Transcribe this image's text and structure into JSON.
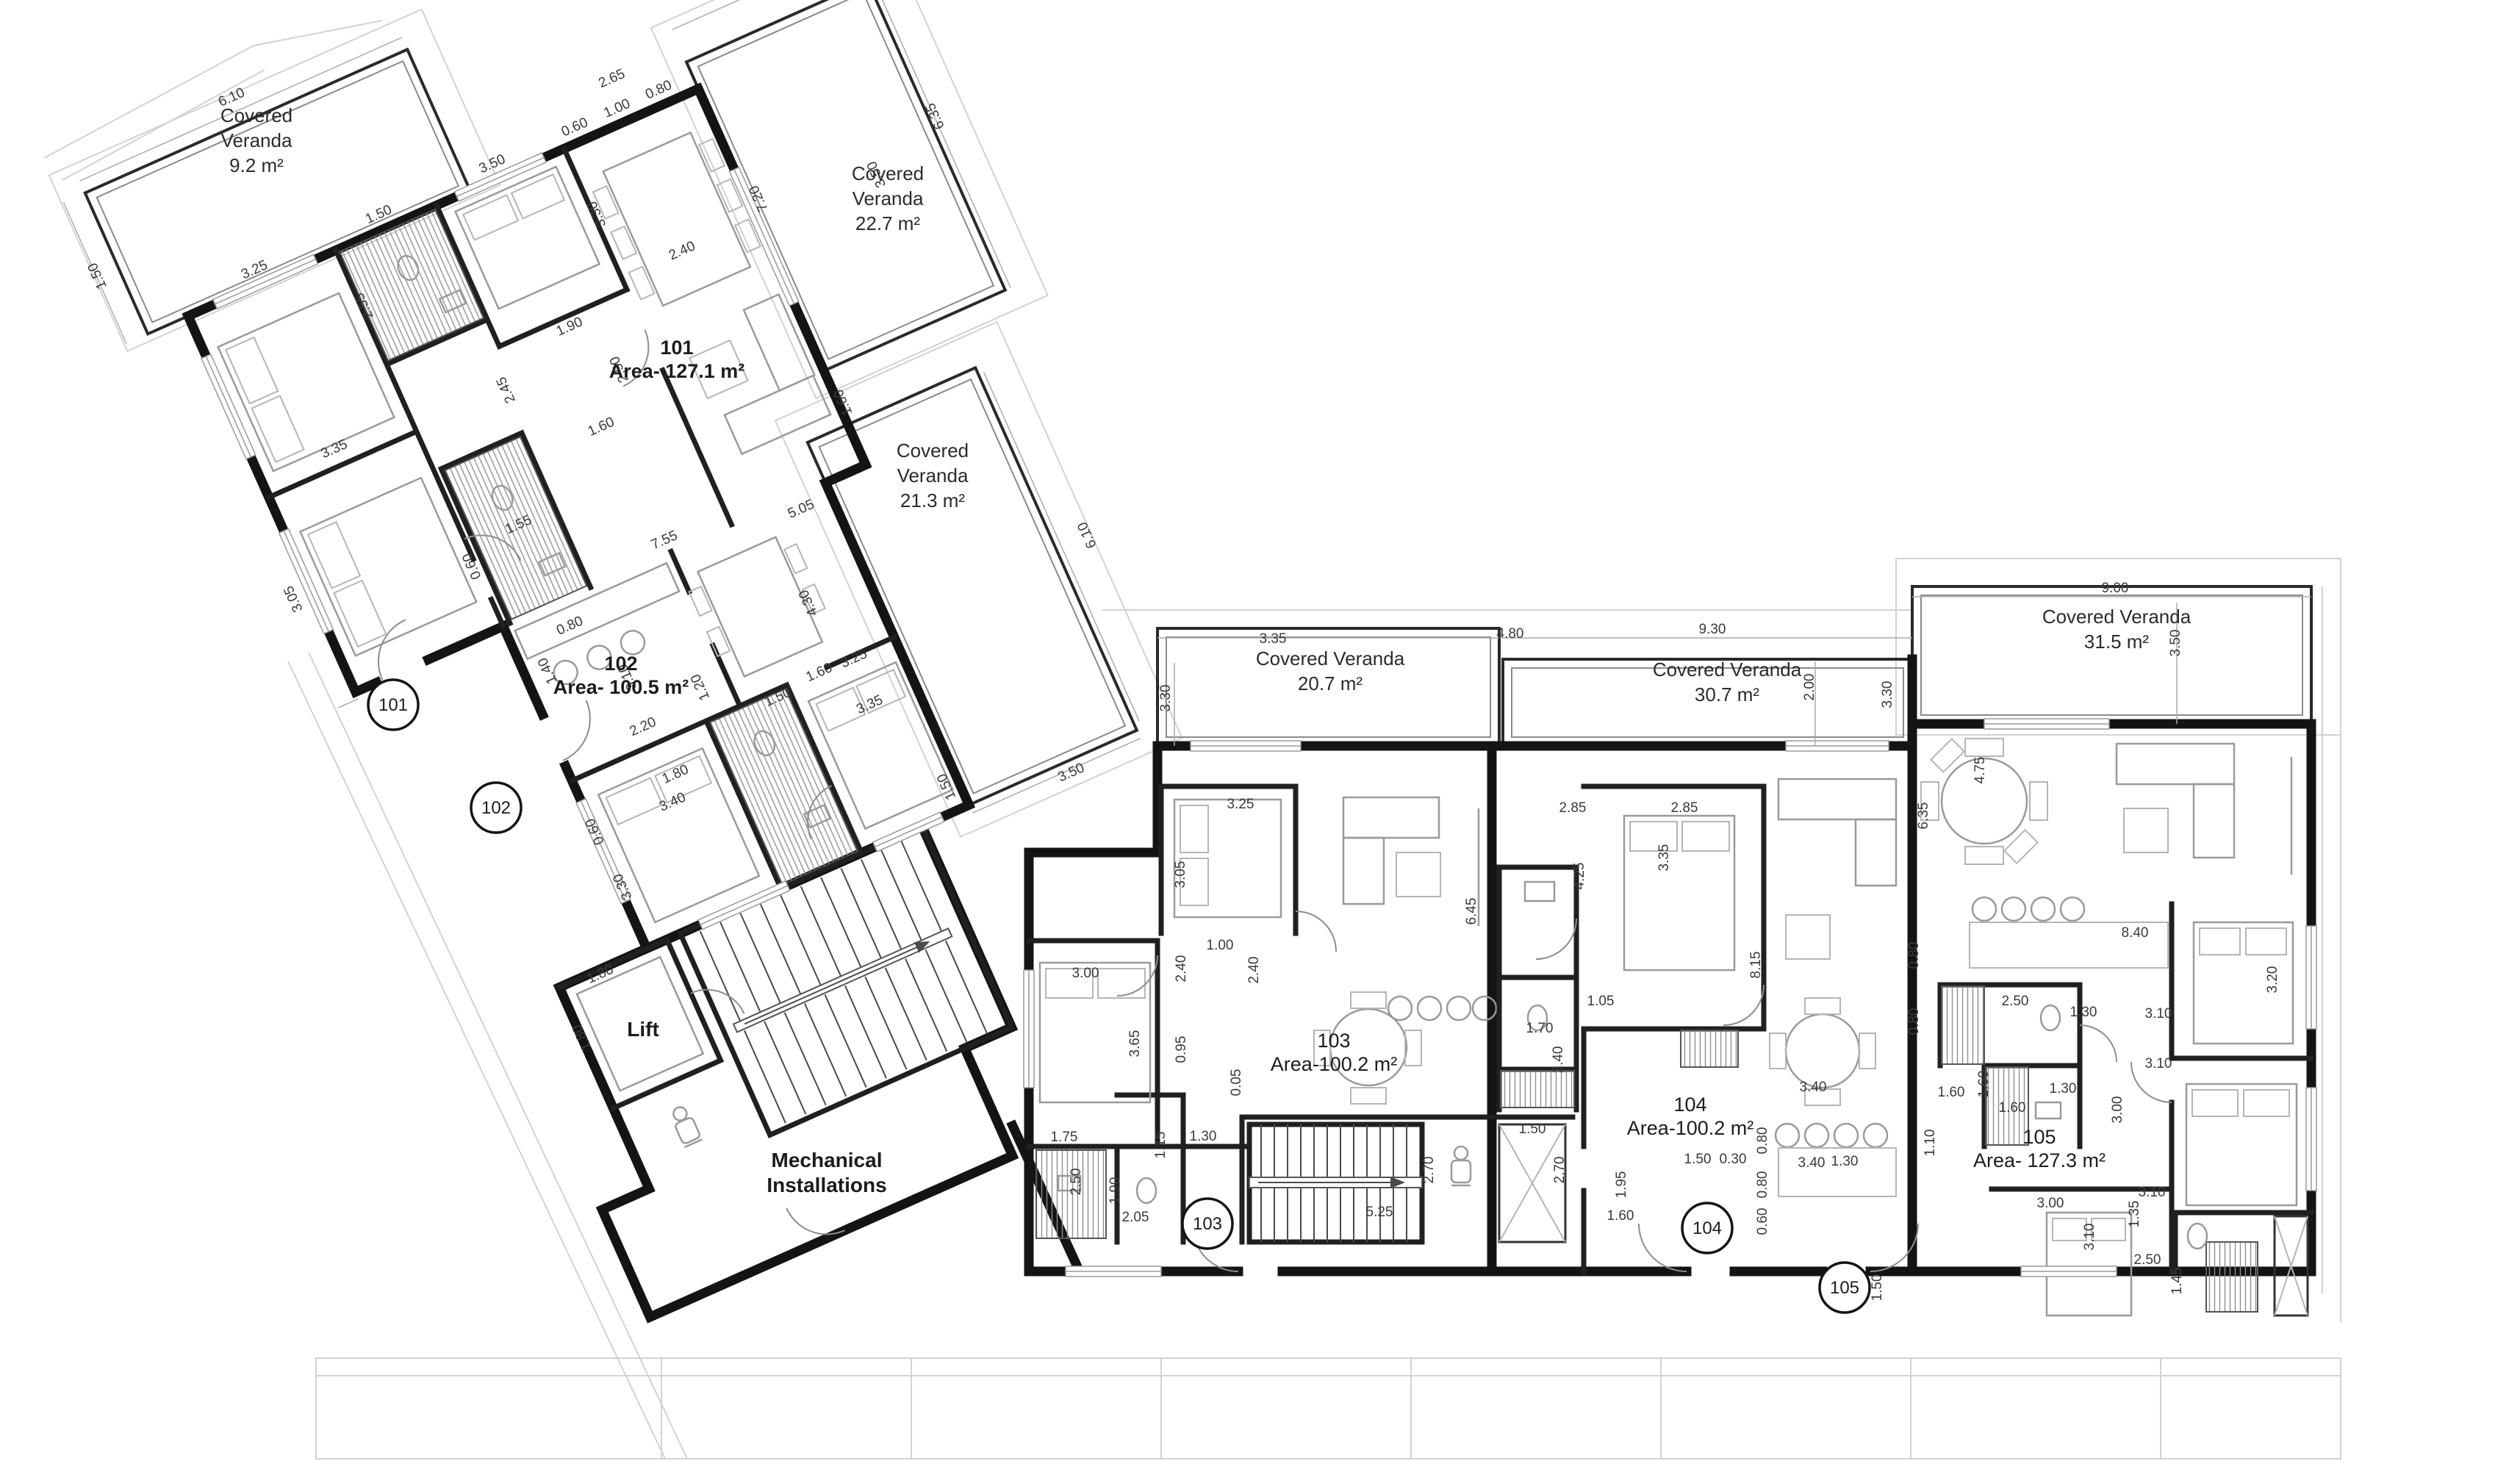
{
  "drawing": {
    "type": "architectural-floor-plan",
    "floor": "apartment level",
    "wall_color": "#141414",
    "paper_color": "#ffffff"
  },
  "apartments": [
    {
      "number": "101",
      "area": "Area- 127.1 m²"
    },
    {
      "number": "102",
      "area": "Area- 100.5 m²"
    },
    {
      "number": "103",
      "area": "Area-100.2 m²"
    },
    {
      "number": "104",
      "area": "Area-100.2 m²"
    },
    {
      "number": "105",
      "area": "Area- 127.3 m²"
    }
  ],
  "verandas": [
    {
      "l1": "Covered",
      "l2": "Veranda",
      "l3": "9.2 m²"
    },
    {
      "l1": "Covered",
      "l2": "Veranda",
      "l3": "22.7 m²"
    },
    {
      "l1": "Covered",
      "l2": "Veranda",
      "l3": "21.3 m²"
    },
    {
      "l1": "Covered Veranda",
      "l2": "20.7 m²"
    },
    {
      "l1": "Covered Veranda",
      "l2": "30.7 m²"
    },
    {
      "l1": "Covered Veranda",
      "l2": "31.5 m²"
    }
  ],
  "rooms": {
    "lift": "Lift",
    "mech1": "Mechanical",
    "mech2": "Installations"
  },
  "bubbles": [
    [
      "101",
      535,
      959
    ],
    [
      "102",
      675,
      1099
    ],
    [
      "103",
      1643,
      1665
    ],
    [
      "104",
      2323,
      1671
    ],
    [
      "105",
      2510,
      1752
    ]
  ],
  "dims": [
    [
      "6.10",
      175,
      -242,
      0,
      "L"
    ],
    [
      "1.50",
      -85,
      -100,
      -90,
      "L"
    ],
    [
      "3.25",
      108,
      -15,
      0,
      "L"
    ],
    [
      "1.50",
      293,
      -15,
      0,
      "L"
    ],
    [
      "2.55",
      230,
      85,
      -90,
      "L"
    ],
    [
      "3.50",
      462,
      -15,
      0,
      "L"
    ],
    [
      "0.60",
      585,
      -15,
      0,
      "L"
    ],
    [
      "1.00",
      648,
      -15,
      0,
      "L"
    ],
    [
      "0.80",
      710,
      -15,
      0,
      "L"
    ],
    [
      "3.30",
      570,
      100,
      -90,
      "L"
    ],
    [
      "2.65",
      658,
      -55,
      0,
      "L"
    ],
    [
      "3.35",
      108,
      252,
      0,
      "L"
    ],
    [
      "3.05",
      -20,
      410,
      -90,
      "L"
    ],
    [
      "2.45",
      360,
      268,
      -90,
      "L"
    ],
    [
      "1.90",
      468,
      230,
      0,
      "L"
    ],
    [
      "1.55",
      295,
      448,
      0,
      "L"
    ],
    [
      "0.60",
      220,
      468,
      -90,
      "L"
    ],
    [
      "1.60",
      452,
      372,
      0,
      "L"
    ],
    [
      "2.50",
      512,
      305,
      -90,
      "L"
    ],
    [
      "2.40",
      650,
      198,
      0,
      "L"
    ],
    [
      "5.05",
      655,
      585,
      0,
      "L"
    ],
    [
      "1.60",
      772,
      470,
      -90,
      "L"
    ],
    [
      "7.20",
      780,
      170,
      -90,
      "L"
    ],
    [
      "3.50",
      940,
      205,
      -90,
      "L"
    ],
    [
      "6.35",
      1045,
      165,
      -90,
      "L"
    ],
    [
      "7.55",
      468,
      548,
      0,
      "L"
    ],
    [
      "4.30",
      618,
      700,
      -90,
      "L"
    ],
    [
      "0.80",
      303,
      602,
      0,
      "L"
    ],
    [
      "1.40",
      256,
      640,
      -90,
      "L"
    ],
    [
      "3.10",
      352,
      692,
      -90,
      "L"
    ],
    [
      "2.20",
      338,
      768,
      0,
      "L"
    ],
    [
      "1.20",
      437,
      745,
      -90,
      "L"
    ],
    [
      "1.50",
      522,
      806,
      0,
      "L"
    ],
    [
      "1.60",
      587,
      798,
      0,
      "L"
    ],
    [
      "1.80",
      352,
      845,
      0,
      "L"
    ],
    [
      "3.40",
      333,
      878,
      0,
      "L"
    ],
    [
      "0.60",
      226,
      866,
      -90,
      "L"
    ],
    [
      "3.30",
      230,
      950,
      -90,
      "L"
    ],
    [
      "3.35",
      632,
      866,
      0,
      "L"
    ],
    [
      "3.25",
      638,
      800,
      0,
      "L"
    ],
    [
      "1.80",
      148,
      1052,
      0,
      "L"
    ],
    [
      "1.80",
      96,
      1115,
      -90,
      "L"
    ],
    [
      "6.10",
      1002,
      770,
      -90,
      "L"
    ],
    [
      "3.50",
      845,
      1062,
      0,
      "L"
    ],
    [
      "1.50",
      688,
      1005,
      -90,
      "L"
    ],
    [
      "3.35",
      1732,
      875,
      0,
      "R"
    ],
    [
      "4.80",
      2055,
      868,
      0,
      "R"
    ],
    [
      "9.30",
      2330,
      862,
      0,
      "R"
    ],
    [
      "3.30",
      1592,
      950,
      -90,
      "R"
    ],
    [
      "2.00",
      2468,
      935,
      -90,
      "R"
    ],
    [
      "3.30",
      2574,
      945,
      -90,
      "R"
    ],
    [
      "9.00",
      2878,
      806,
      0,
      "R"
    ],
    [
      "3.50",
      2966,
      875,
      -90,
      "R"
    ],
    [
      "3.25",
      1688,
      1100,
      0,
      "R"
    ],
    [
      "3.05",
      1612,
      1190,
      -90,
      "R"
    ],
    [
      "6.45",
      2008,
      1240,
      -90,
      "R"
    ],
    [
      "3.00",
      1477,
      1330,
      0,
      "R"
    ],
    [
      "3.65",
      1550,
      1420,
      -90,
      "R"
    ],
    [
      "2.40",
      1613,
      1318,
      -90,
      "R"
    ],
    [
      "0.95",
      1613,
      1428,
      -90,
      "R"
    ],
    [
      "1.00",
      1660,
      1292,
      0,
      "R"
    ],
    [
      "2.40",
      1712,
      1320,
      -90,
      "R"
    ],
    [
      "0.05",
      1688,
      1473,
      -90,
      "R"
    ],
    [
      "1.75",
      1448,
      1553,
      0,
      "R"
    ],
    [
      "2.50",
      1470,
      1608,
      -90,
      "R"
    ],
    [
      "1.90",
      1523,
      1620,
      -90,
      "R"
    ],
    [
      "1.15",
      1585,
      1558,
      -90,
      "R"
    ],
    [
      "1.30",
      1637,
      1552,
      0,
      "R"
    ],
    [
      "2.05",
      1545,
      1662,
      0,
      "R"
    ],
    [
      "5.25",
      1877,
      1655,
      0,
      "R"
    ],
    [
      "2.70",
      1950,
      1592,
      -90,
      "R"
    ],
    [
      "1.50",
      2085,
      1542,
      0,
      "R"
    ],
    [
      "2.70",
      2128,
      1592,
      -90,
      "R"
    ],
    [
      "2.85",
      2140,
      1105,
      0,
      "R"
    ],
    [
      "2.85",
      2292,
      1105,
      0,
      "R"
    ],
    [
      "4.25",
      2155,
      1192,
      -90,
      "R"
    ],
    [
      "3.35",
      2270,
      1167,
      -90,
      "R"
    ],
    [
      "8.15",
      2395,
      1313,
      -90,
      "R"
    ],
    [
      "1.05",
      2178,
      1368,
      0,
      "R"
    ],
    [
      "1.70",
      2095,
      1405,
      0,
      "R"
    ],
    [
      "2.40",
      2126,
      1442,
      -90,
      "R"
    ],
    [
      "3.40",
      2467,
      1485,
      0,
      "R"
    ],
    [
      "3.40",
      2465,
      1588,
      0,
      "R"
    ],
    [
      "0.80",
      2404,
      1552,
      -90,
      "R"
    ],
    [
      "0.80",
      2404,
      1612,
      -90,
      "R"
    ],
    [
      "0.60",
      2404,
      1662,
      -90,
      "R"
    ],
    [
      "1.50",
      2310,
      1583,
      0,
      "R"
    ],
    [
      "0.30",
      2358,
      1583,
      0,
      "R"
    ],
    [
      "1.95",
      2212,
      1612,
      -90,
      "R"
    ],
    [
      "1.60",
      2205,
      1660,
      0,
      "R"
    ],
    [
      "1.30",
      2510,
      1586,
      0,
      "R"
    ],
    [
      "1.50",
      2560,
      1752,
      -90,
      "R"
    ],
    [
      "1.10",
      2632,
      1555,
      -90,
      "R"
    ],
    [
      "1.60",
      2655,
      1492,
      0,
      "R"
    ],
    [
      "6.35",
      2623,
      1110,
      -90,
      "R"
    ],
    [
      "4.75",
      2700,
      1048,
      -90,
      "R"
    ],
    [
      "8.40",
      2905,
      1275,
      0,
      "R"
    ],
    [
      "0.80",
      2610,
      1300,
      -90,
      "R"
    ],
    [
      "0.80",
      2610,
      1390,
      -90,
      "R"
    ],
    [
      "2.50",
      2742,
      1368,
      0,
      "R"
    ],
    [
      "1.30",
      2835,
      1383,
      0,
      "R"
    ],
    [
      "3.10",
      2937,
      1385,
      0,
      "R"
    ],
    [
      "3.20",
      3098,
      1333,
      -90,
      "R"
    ],
    [
      "1.60",
      2705,
      1475,
      -90,
      "R"
    ],
    [
      "1.60",
      2738,
      1513,
      0,
      "R"
    ],
    [
      "1.30",
      2807,
      1487,
      0,
      "R"
    ],
    [
      "3.00",
      2887,
      1510,
      -90,
      "R"
    ],
    [
      "3.10",
      2937,
      1453,
      0,
      "R"
    ],
    [
      "3.00",
      2790,
      1643,
      0,
      "R"
    ],
    [
      "3.10",
      2849,
      1683,
      -90,
      "R"
    ],
    [
      "1.35",
      2910,
      1652,
      -90,
      "R"
    ],
    [
      "3.10",
      2928,
      1628,
      0,
      "R"
    ],
    [
      "2.50",
      2922,
      1720,
      0,
      "R"
    ],
    [
      "1.45",
      2968,
      1743,
      -90,
      "R"
    ]
  ]
}
